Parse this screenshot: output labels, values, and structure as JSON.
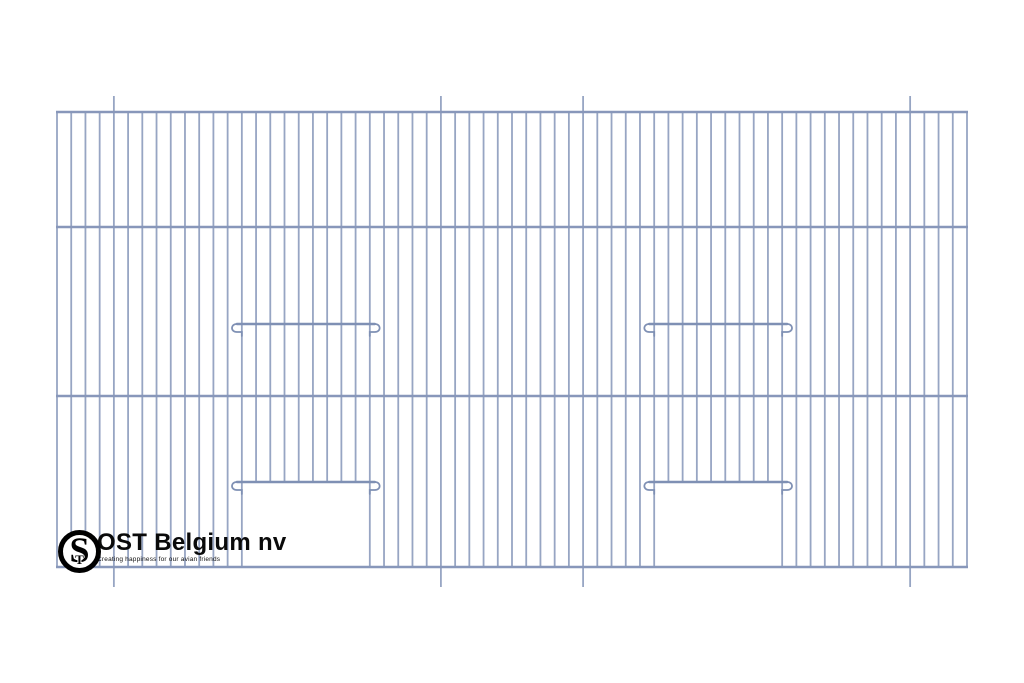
{
  "page": {
    "background": "#ffffff"
  },
  "brand": {
    "name": "OST Belgium nv",
    "tagline": "Creating happiness for our avian friends",
    "monogram_s": "S",
    "monogram_t": "T"
  },
  "drawing": {
    "label": "bird-cage-front-panel",
    "canvas": {
      "width": 1024,
      "height": 683
    },
    "panel": {
      "left": 57,
      "top": 112,
      "right": 967,
      "bottom": 567
    },
    "rail_ys": [
      112,
      227,
      396,
      567
    ],
    "wire_count": 65,
    "extended_wire_indices": [
      4,
      27,
      37,
      60
    ],
    "extension_top": 16,
    "extension_bottom": 20,
    "doors": [
      {
        "left_wire": 13,
        "right_wire": 22,
        "bar_y": 482
      },
      {
        "left_wire": 42,
        "right_wire": 51,
        "bar_y": 482
      }
    ],
    "perch_bars": [
      {
        "left_wire": 13,
        "right_wire": 22,
        "bar_y": 324
      },
      {
        "left_wire": 42,
        "right_wire": 51,
        "bar_y": 324
      }
    ],
    "colors": {
      "wire": "#97a5c3",
      "rail": "#8897ba",
      "bar": "#7f90b4"
    },
    "stroke": {
      "wire": 1.8,
      "rail": 2.6,
      "bar": 2.4,
      "hook": 1.8
    }
  }
}
